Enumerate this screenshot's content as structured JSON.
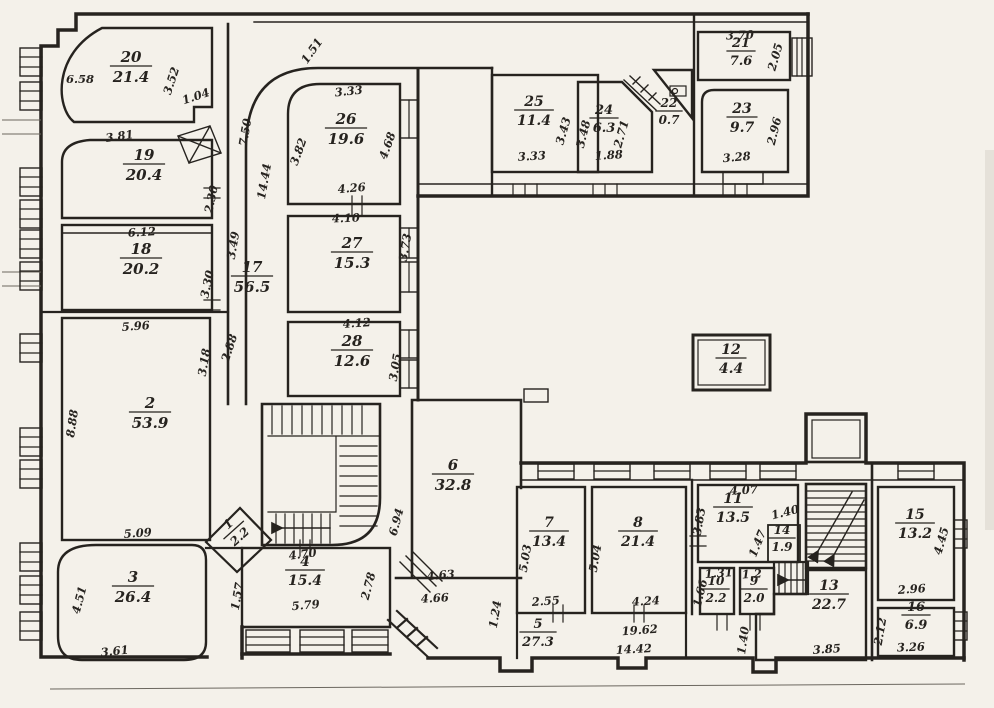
{
  "plan_title": "apartment-floor-plan",
  "colors": {
    "ink": "#26231f",
    "paper": "#f4f1ea"
  },
  "rooms": [
    {
      "number": "20",
      "area": "21.4",
      "x": 131,
      "y": 62,
      "rot": 0,
      "size": 15
    },
    {
      "number": "19",
      "area": "20.4",
      "x": 144,
      "y": 160,
      "rot": 0,
      "size": 15
    },
    {
      "number": "18",
      "area": "20.2",
      "x": 141,
      "y": 254,
      "rot": 0,
      "size": 15
    },
    {
      "number": "17",
      "area": "56.5",
      "x": 252,
      "y": 272,
      "rot": 0,
      "size": 15
    },
    {
      "number": "2",
      "area": "53.9",
      "x": 150,
      "y": 408,
      "rot": 0,
      "size": 15
    },
    {
      "number": "3",
      "area": "26.4",
      "x": 133,
      "y": 582,
      "rot": 0,
      "size": 15
    },
    {
      "number": "1",
      "area": "2.2",
      "x": 231,
      "y": 527,
      "rot": -42,
      "size": 12
    },
    {
      "number": "4",
      "area": "15.4",
      "x": 305,
      "y": 566,
      "rot": 0,
      "size": 14
    },
    {
      "number": "26",
      "area": "19.6",
      "x": 346,
      "y": 124,
      "rot": 0,
      "size": 15
    },
    {
      "number": "27",
      "area": "15.3",
      "x": 352,
      "y": 248,
      "rot": 0,
      "size": 15
    },
    {
      "number": "28",
      "area": "12.6",
      "x": 352,
      "y": 346,
      "rot": 0,
      "size": 15
    },
    {
      "number": "6",
      "area": "32.8",
      "x": 453,
      "y": 470,
      "rot": 0,
      "size": 15
    },
    {
      "number": "5",
      "area": "27.3",
      "x": 538,
      "y": 628,
      "rot": 0,
      "size": 13
    },
    {
      "number": "7",
      "area": "13.4",
      "x": 549,
      "y": 527,
      "rot": 0,
      "size": 14
    },
    {
      "number": "8",
      "area": "21.4",
      "x": 638,
      "y": 527,
      "rot": 0,
      "size": 14
    },
    {
      "number": "25",
      "area": "11.4",
      "x": 534,
      "y": 106,
      "rot": 0,
      "size": 14
    },
    {
      "number": "24",
      "area": "6.3",
      "x": 604,
      "y": 114,
      "rot": 0,
      "size": 13
    },
    {
      "number": "22",
      "area": "0.7",
      "x": 669,
      "y": 107,
      "rot": 0,
      "size": 12
    },
    {
      "number": "21",
      "area": "7.6",
      "x": 741,
      "y": 47,
      "rot": 0,
      "size": 13
    },
    {
      "number": "23",
      "area": "9.7",
      "x": 742,
      "y": 113,
      "rot": 0,
      "size": 14
    },
    {
      "number": "12",
      "area": "4.4",
      "x": 731,
      "y": 354,
      "rot": 0,
      "size": 14
    },
    {
      "number": "11",
      "area": "13.5",
      "x": 733,
      "y": 503,
      "rot": 0,
      "size": 14
    },
    {
      "number": "14",
      "area": "1.9",
      "x": 782,
      "y": 534,
      "rot": 0,
      "size": 12
    },
    {
      "number": "10",
      "area": "2.2",
      "x": 716,
      "y": 585,
      "rot": 0,
      "size": 12
    },
    {
      "number": "9",
      "area": "2.0",
      "x": 754,
      "y": 585,
      "rot": 0,
      "size": 12
    },
    {
      "number": "13",
      "area": "22.7",
      "x": 829,
      "y": 590,
      "rot": 0,
      "size": 14
    },
    {
      "number": "15",
      "area": "13.2",
      "x": 915,
      "y": 519,
      "rot": 0,
      "size": 14
    },
    {
      "number": "16",
      "area": "6.9",
      "x": 916,
      "y": 611,
      "rot": 0,
      "size": 13
    }
  ],
  "dims": [
    {
      "t": "6.58",
      "x": 80,
      "y": 83,
      "r": 0
    },
    {
      "t": "3.52",
      "x": 175,
      "y": 82,
      "r": -72
    },
    {
      "t": "1.04",
      "x": 197,
      "y": 100,
      "r": -18
    },
    {
      "t": "3.81",
      "x": 120,
      "y": 140,
      "r": -8
    },
    {
      "t": "2.30",
      "x": 215,
      "y": 200,
      "r": -78
    },
    {
      "t": "6.12",
      "x": 142,
      "y": 236,
      "r": -3
    },
    {
      "t": "3.30",
      "x": 211,
      "y": 285,
      "r": -78
    },
    {
      "t": "3.49",
      "x": 237,
      "y": 246,
      "r": -80
    },
    {
      "t": "5.96",
      "x": 136,
      "y": 330,
      "r": -4
    },
    {
      "t": "8.88",
      "x": 76,
      "y": 424,
      "r": -82
    },
    {
      "t": "3.18",
      "x": 208,
      "y": 363,
      "r": -80
    },
    {
      "t": "2.88",
      "x": 233,
      "y": 349,
      "r": -72
    },
    {
      "t": "5.09",
      "x": 138,
      "y": 537,
      "r": -4
    },
    {
      "t": "4.51",
      "x": 83,
      "y": 601,
      "r": -75
    },
    {
      "t": "3.61",
      "x": 115,
      "y": 655,
      "r": -6
    },
    {
      "t": "1.57",
      "x": 241,
      "y": 597,
      "r": -80
    },
    {
      "t": "4.70",
      "x": 303,
      "y": 558,
      "r": -7
    },
    {
      "t": "5.79",
      "x": 306,
      "y": 609,
      "r": -5
    },
    {
      "t": "2.78",
      "x": 372,
      "y": 587,
      "r": -75
    },
    {
      "t": "1.51",
      "x": 315,
      "y": 53,
      "r": -55
    },
    {
      "t": "7.50",
      "x": 249,
      "y": 133,
      "r": -80
    },
    {
      "t": "14.44",
      "x": 268,
      "y": 182,
      "r": -80
    },
    {
      "t": "3.33",
      "x": 349,
      "y": 95,
      "r": -6
    },
    {
      "t": "3.82",
      "x": 302,
      "y": 153,
      "r": -70
    },
    {
      "t": "4.68",
      "x": 391,
      "y": 147,
      "r": -70
    },
    {
      "t": "4.26",
      "x": 352,
      "y": 192,
      "r": -5
    },
    {
      "t": "4.10",
      "x": 346,
      "y": 222,
      "r": -2
    },
    {
      "t": "3.73",
      "x": 409,
      "y": 248,
      "r": -80
    },
    {
      "t": "4.12",
      "x": 357,
      "y": 327,
      "r": -4
    },
    {
      "t": "3.05",
      "x": 399,
      "y": 368,
      "r": -80
    },
    {
      "t": "6.94",
      "x": 400,
      "y": 523,
      "r": -75
    },
    {
      "t": "4.63",
      "x": 441,
      "y": 579,
      "r": -5
    },
    {
      "t": "4.66",
      "x": 435,
      "y": 602,
      "r": -3
    },
    {
      "t": "1.24",
      "x": 499,
      "y": 615,
      "r": -80
    },
    {
      "t": "5.03",
      "x": 529,
      "y": 559,
      "r": -80
    },
    {
      "t": "2.55",
      "x": 546,
      "y": 605,
      "r": -4
    },
    {
      "t": "5.04",
      "x": 599,
      "y": 559,
      "r": -80
    },
    {
      "t": "4.24",
      "x": 646,
      "y": 605,
      "r": -3
    },
    {
      "t": "19.62",
      "x": 640,
      "y": 634,
      "r": -4
    },
    {
      "t": "14.42",
      "x": 634,
      "y": 653,
      "r": -3
    },
    {
      "t": "3.33",
      "x": 532,
      "y": 160,
      "r": -3
    },
    {
      "t": "3.43",
      "x": 567,
      "y": 132,
      "r": -74
    },
    {
      "t": "3.48",
      "x": 587,
      "y": 135,
      "r": -76
    },
    {
      "t": "2.71",
      "x": 625,
      "y": 135,
      "r": -74
    },
    {
      "t": "1.88",
      "x": 609,
      "y": 159,
      "r": -3
    },
    {
      "t": "3.70",
      "x": 740,
      "y": 39,
      "r": -2
    },
    {
      "t": "2.05",
      "x": 779,
      "y": 58,
      "r": -74
    },
    {
      "t": "2.96",
      "x": 778,
      "y": 132,
      "r": -76
    },
    {
      "t": "3.28",
      "x": 737,
      "y": 161,
      "r": -5
    },
    {
      "t": "4.07",
      "x": 744,
      "y": 494,
      "r": -3
    },
    {
      "t": "3.83",
      "x": 703,
      "y": 522,
      "r": -80
    },
    {
      "t": "1.47",
      "x": 761,
      "y": 545,
      "r": -68
    },
    {
      "t": "1.40",
      "x": 786,
      "y": 516,
      "r": -14
    },
    {
      "t": "1.31",
      "x": 719,
      "y": 577,
      "r": -4
    },
    {
      "t": "1.66",
      "x": 704,
      "y": 594,
      "r": -76
    },
    {
      "t": "1.2",
      "x": 752,
      "y": 578,
      "r": -3
    },
    {
      "t": "1.40",
      "x": 747,
      "y": 641,
      "r": -82
    },
    {
      "t": "3.85",
      "x": 827,
      "y": 653,
      "r": -4
    },
    {
      "t": "2.12",
      "x": 884,
      "y": 632,
      "r": -80
    },
    {
      "t": "3.26",
      "x": 911,
      "y": 651,
      "r": -2
    },
    {
      "t": "4.45",
      "x": 945,
      "y": 542,
      "r": -74
    },
    {
      "t": "2.96",
      "x": 912,
      "y": 593,
      "r": -4
    }
  ]
}
